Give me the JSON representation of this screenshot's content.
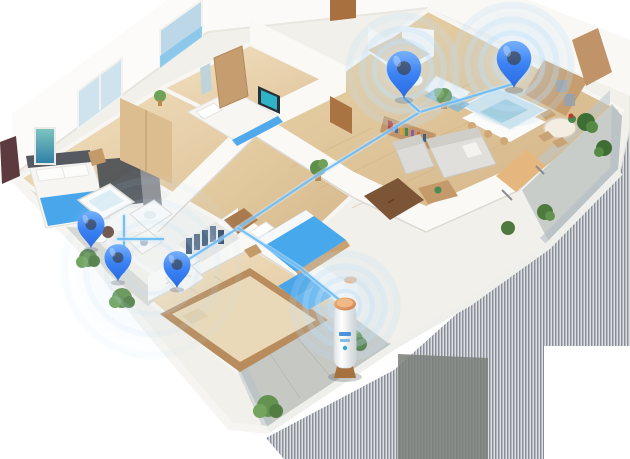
{
  "scene": {
    "kind": "isometric-apartment-floorplan",
    "description": "3D cutaway floor plan of an apartment with blue smart-device location pins connected by light-blue lines to a cylindrical hub unit standing on the south balcony; striped gray shadow cast to the lower right",
    "background": "#ffffff",
    "width": 630,
    "height": 459
  },
  "palette": {
    "pin_blue": "#3b82f4",
    "pin_blue_light": "#85bcfd",
    "connection_line": "#6fbdf4",
    "connection_glow": "#cfe8fb",
    "ripple": "#bfe0f9",
    "wood_floor": "#e8d2a9",
    "wall_white": "#fbfaf7",
    "tile_white": "#f3f2ee",
    "bedding_blue": "#45a7ec",
    "balcony_concrete": "#c7c9c3",
    "glass": "#bccdd6",
    "shadow_stripe_dark": "#6a717b",
    "shadow_stripe_light": "#aeb4ba",
    "shadow_solid": "#7d827d",
    "hub_cap_orange": "#e2995f",
    "hub_body_white": "#f4f6f7",
    "hub_label_blue": "#3a87d8",
    "greenery": "#5f8f4a",
    "furniture_wood": "#c49a6c"
  },
  "rooms": [
    {
      "id": "bedroom-1"
    },
    {
      "id": "bedroom-2"
    },
    {
      "id": "toilet"
    },
    {
      "id": "kitchen"
    },
    {
      "id": "living-dining"
    },
    {
      "id": "hallway"
    },
    {
      "id": "bedroom-3"
    },
    {
      "id": "walk-in-closet"
    },
    {
      "id": "bathroom-washroom"
    },
    {
      "id": "tatami-room"
    },
    {
      "id": "balcony-west"
    },
    {
      "id": "balcony-south"
    },
    {
      "id": "balcony-east"
    }
  ],
  "pins": [
    {
      "id": "pin-toilet",
      "room": "toilet",
      "x": 404,
      "y": 98,
      "scale": 1.15
    },
    {
      "id": "pin-kitchen",
      "room": "kitchen",
      "x": 514,
      "y": 88,
      "scale": 1.15
    },
    {
      "id": "pin-bathroom",
      "room": "bathroom-washroom",
      "x": 91,
      "y": 248,
      "scale": 0.9
    },
    {
      "id": "pin-washroom",
      "room": "bathroom-washroom",
      "x": 118,
      "y": 281,
      "scale": 0.9
    },
    {
      "id": "pin-closet",
      "room": "walk-in-closet",
      "x": 177,
      "y": 288,
      "scale": 0.9
    }
  ],
  "ripples": [
    {
      "id": "ripple-toilet",
      "cx": 403,
      "cy": 70,
      "base": 57,
      "opacity": 1
    },
    {
      "id": "ripple-kitchen",
      "cx": 512,
      "cy": 64,
      "base": 62,
      "opacity": 1
    },
    {
      "id": "ripple-hub",
      "cx": 345,
      "cy": 306,
      "base": 55,
      "opacity": 0.9
    },
    {
      "id": "ripple-washroom",
      "cx": 152,
      "cy": 268,
      "base": 92,
      "opacity": 0.38
    }
  ],
  "connections": [
    {
      "id": "link-kitchen-to-closet",
      "points": [
        [
          513,
          84
        ],
        [
          420,
          112
        ],
        [
          316,
          176
        ],
        [
          235,
          230
        ],
        [
          178,
          266
        ]
      ]
    },
    {
      "id": "link-toilet-branch",
      "points": [
        [
          404,
          98
        ],
        [
          419,
          111
        ]
      ]
    },
    {
      "id": "link-hub-branch",
      "points": [
        [
          238,
          228
        ],
        [
          300,
          268
        ],
        [
          342,
          302
        ]
      ]
    },
    {
      "id": "link-washroom-vertical",
      "points": [
        [
          124,
          216
        ],
        [
          124,
          272
        ]
      ]
    },
    {
      "id": "link-washroom-horizontal",
      "points": [
        [
          118,
          239
        ],
        [
          163,
          239
        ]
      ]
    }
  ],
  "hub_device": {
    "id": "hub-unit",
    "room": "balcony-south",
    "x": 345,
    "y": 372
  }
}
